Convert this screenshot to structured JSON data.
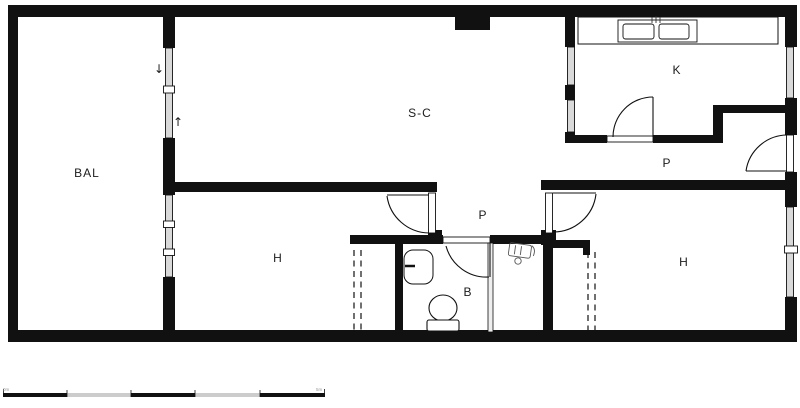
{
  "plan": {
    "rooms": [
      {
        "key": "balcony",
        "label": "BAL"
      },
      {
        "key": "living",
        "label": "S-C"
      },
      {
        "key": "kitchen",
        "label": "K"
      },
      {
        "key": "hall-right",
        "label": "P"
      },
      {
        "key": "corridor",
        "label": "P"
      },
      {
        "key": "bedroom-left",
        "label": "H"
      },
      {
        "key": "bedroom-right",
        "label": "H"
      },
      {
        "key": "bathroom",
        "label": "B"
      }
    ],
    "sliding_window_arrows": {
      "down": "↓",
      "up": "↑"
    },
    "scale_bar": {
      "left_label": "0m",
      "right_label": "5m"
    },
    "colors": {
      "wall": "#111111",
      "window_fill": "#d9d9d9",
      "scale_gray": "#cccccc"
    }
  }
}
